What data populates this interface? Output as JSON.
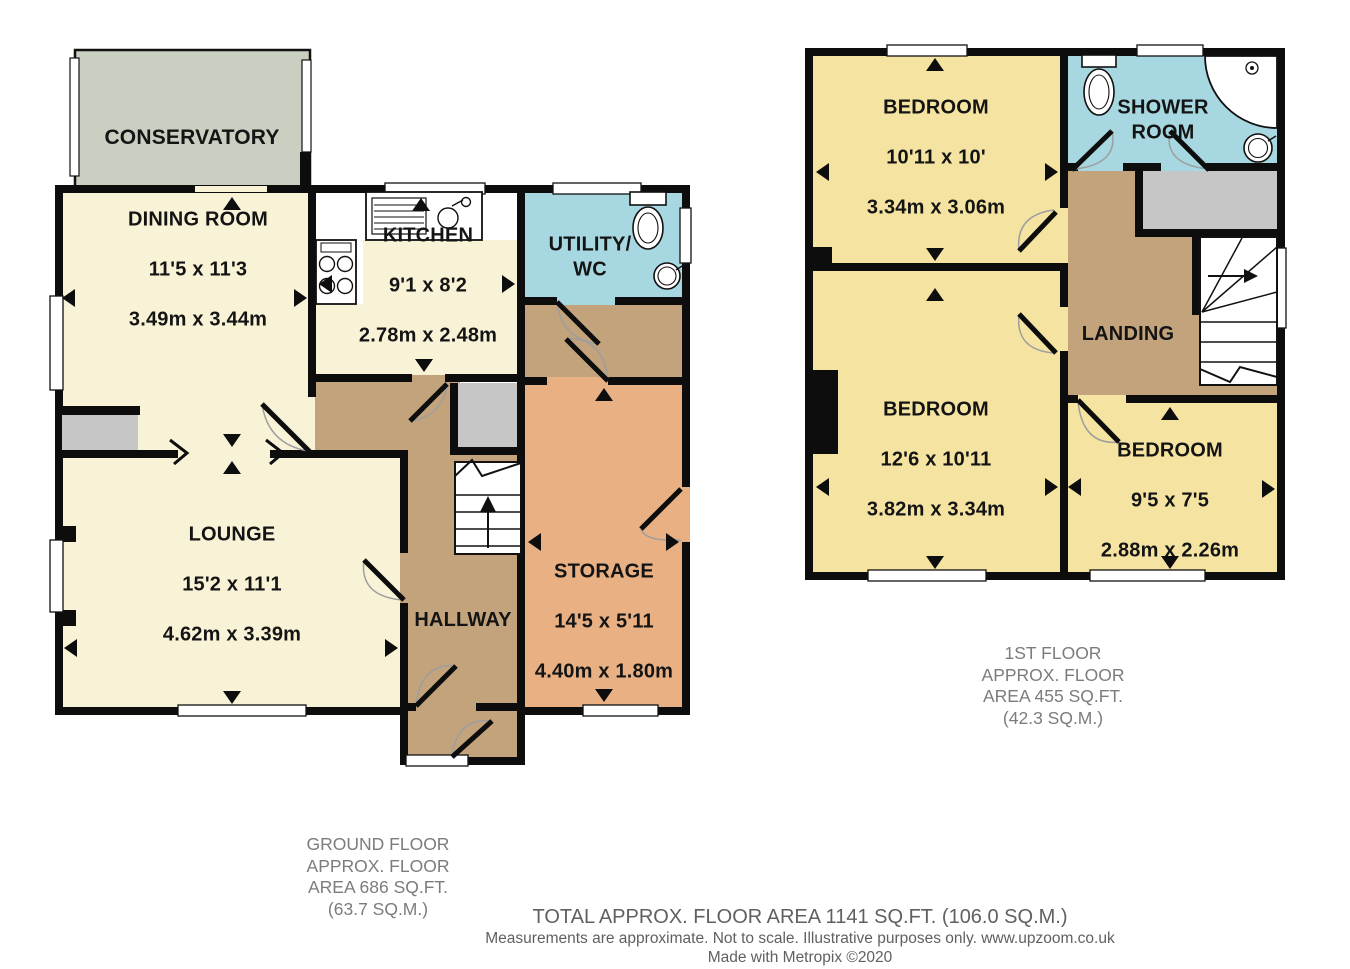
{
  "ground_floor": {
    "rooms": {
      "conservatory": {
        "name": "CONSERVATORY"
      },
      "dining_room": {
        "name": "DINING ROOM",
        "imperial": "11'5 x 11'3",
        "metric": "3.49m x 3.44m"
      },
      "kitchen": {
        "name": "KITCHEN",
        "imperial": "9'1 x 8'2",
        "metric": "2.78m x 2.48m"
      },
      "utility_wc": {
        "name": "UTILITY/\nWC"
      },
      "lounge": {
        "name": "LOUNGE",
        "imperial": "15'2 x 11'1",
        "metric": "4.62m x 3.39m"
      },
      "hallway": {
        "name": "HALLWAY"
      },
      "storage": {
        "name": "STORAGE",
        "imperial": "14'5 x 5'11",
        "metric": "4.40m x 1.80m"
      }
    },
    "caption": "GROUND FLOOR\nAPPROX. FLOOR\nAREA 686 SQ.FT.\n(63.7 SQ.M.)"
  },
  "first_floor": {
    "rooms": {
      "bedroom_1": {
        "name": "BEDROOM",
        "imperial": "10'11 x 10'",
        "metric": "3.34m x 3.06m"
      },
      "shower_room": {
        "name": "SHOWER\nROOM"
      },
      "landing": {
        "name": "LANDING"
      },
      "bedroom_2": {
        "name": "BEDROOM",
        "imperial": "12'6 x 10'11",
        "metric": "3.82m x 3.34m"
      },
      "bedroom_3": {
        "name": "BEDROOM",
        "imperial": "9'5 x 7'5",
        "metric": "2.88m x 2.26m"
      }
    },
    "caption": "1ST FLOOR\nAPPROX. FLOOR\nAREA 455 SQ.FT.\n(42.3 SQ.M.)"
  },
  "footer": {
    "total": "TOTAL APPROX. FLOOR AREA 1141 SQ.FT. (106.0 SQ.M.)",
    "disclaimer": "Measurements are approximate. Not to scale. Illustrative purposes only. www.upzoom.co.uk",
    "credit": "Made with Metropix ©2020"
  },
  "colors": {
    "room_cream": "#f8f3d7",
    "room_yellow": "#f5e4a1",
    "room_tan": "#c3a37c",
    "room_orange": "#e9b183",
    "room_blue": "#a7d7e0",
    "room_green": "#c9cfc1",
    "block_gray": "#c6c6c6",
    "wall": "#0d0d0d"
  }
}
